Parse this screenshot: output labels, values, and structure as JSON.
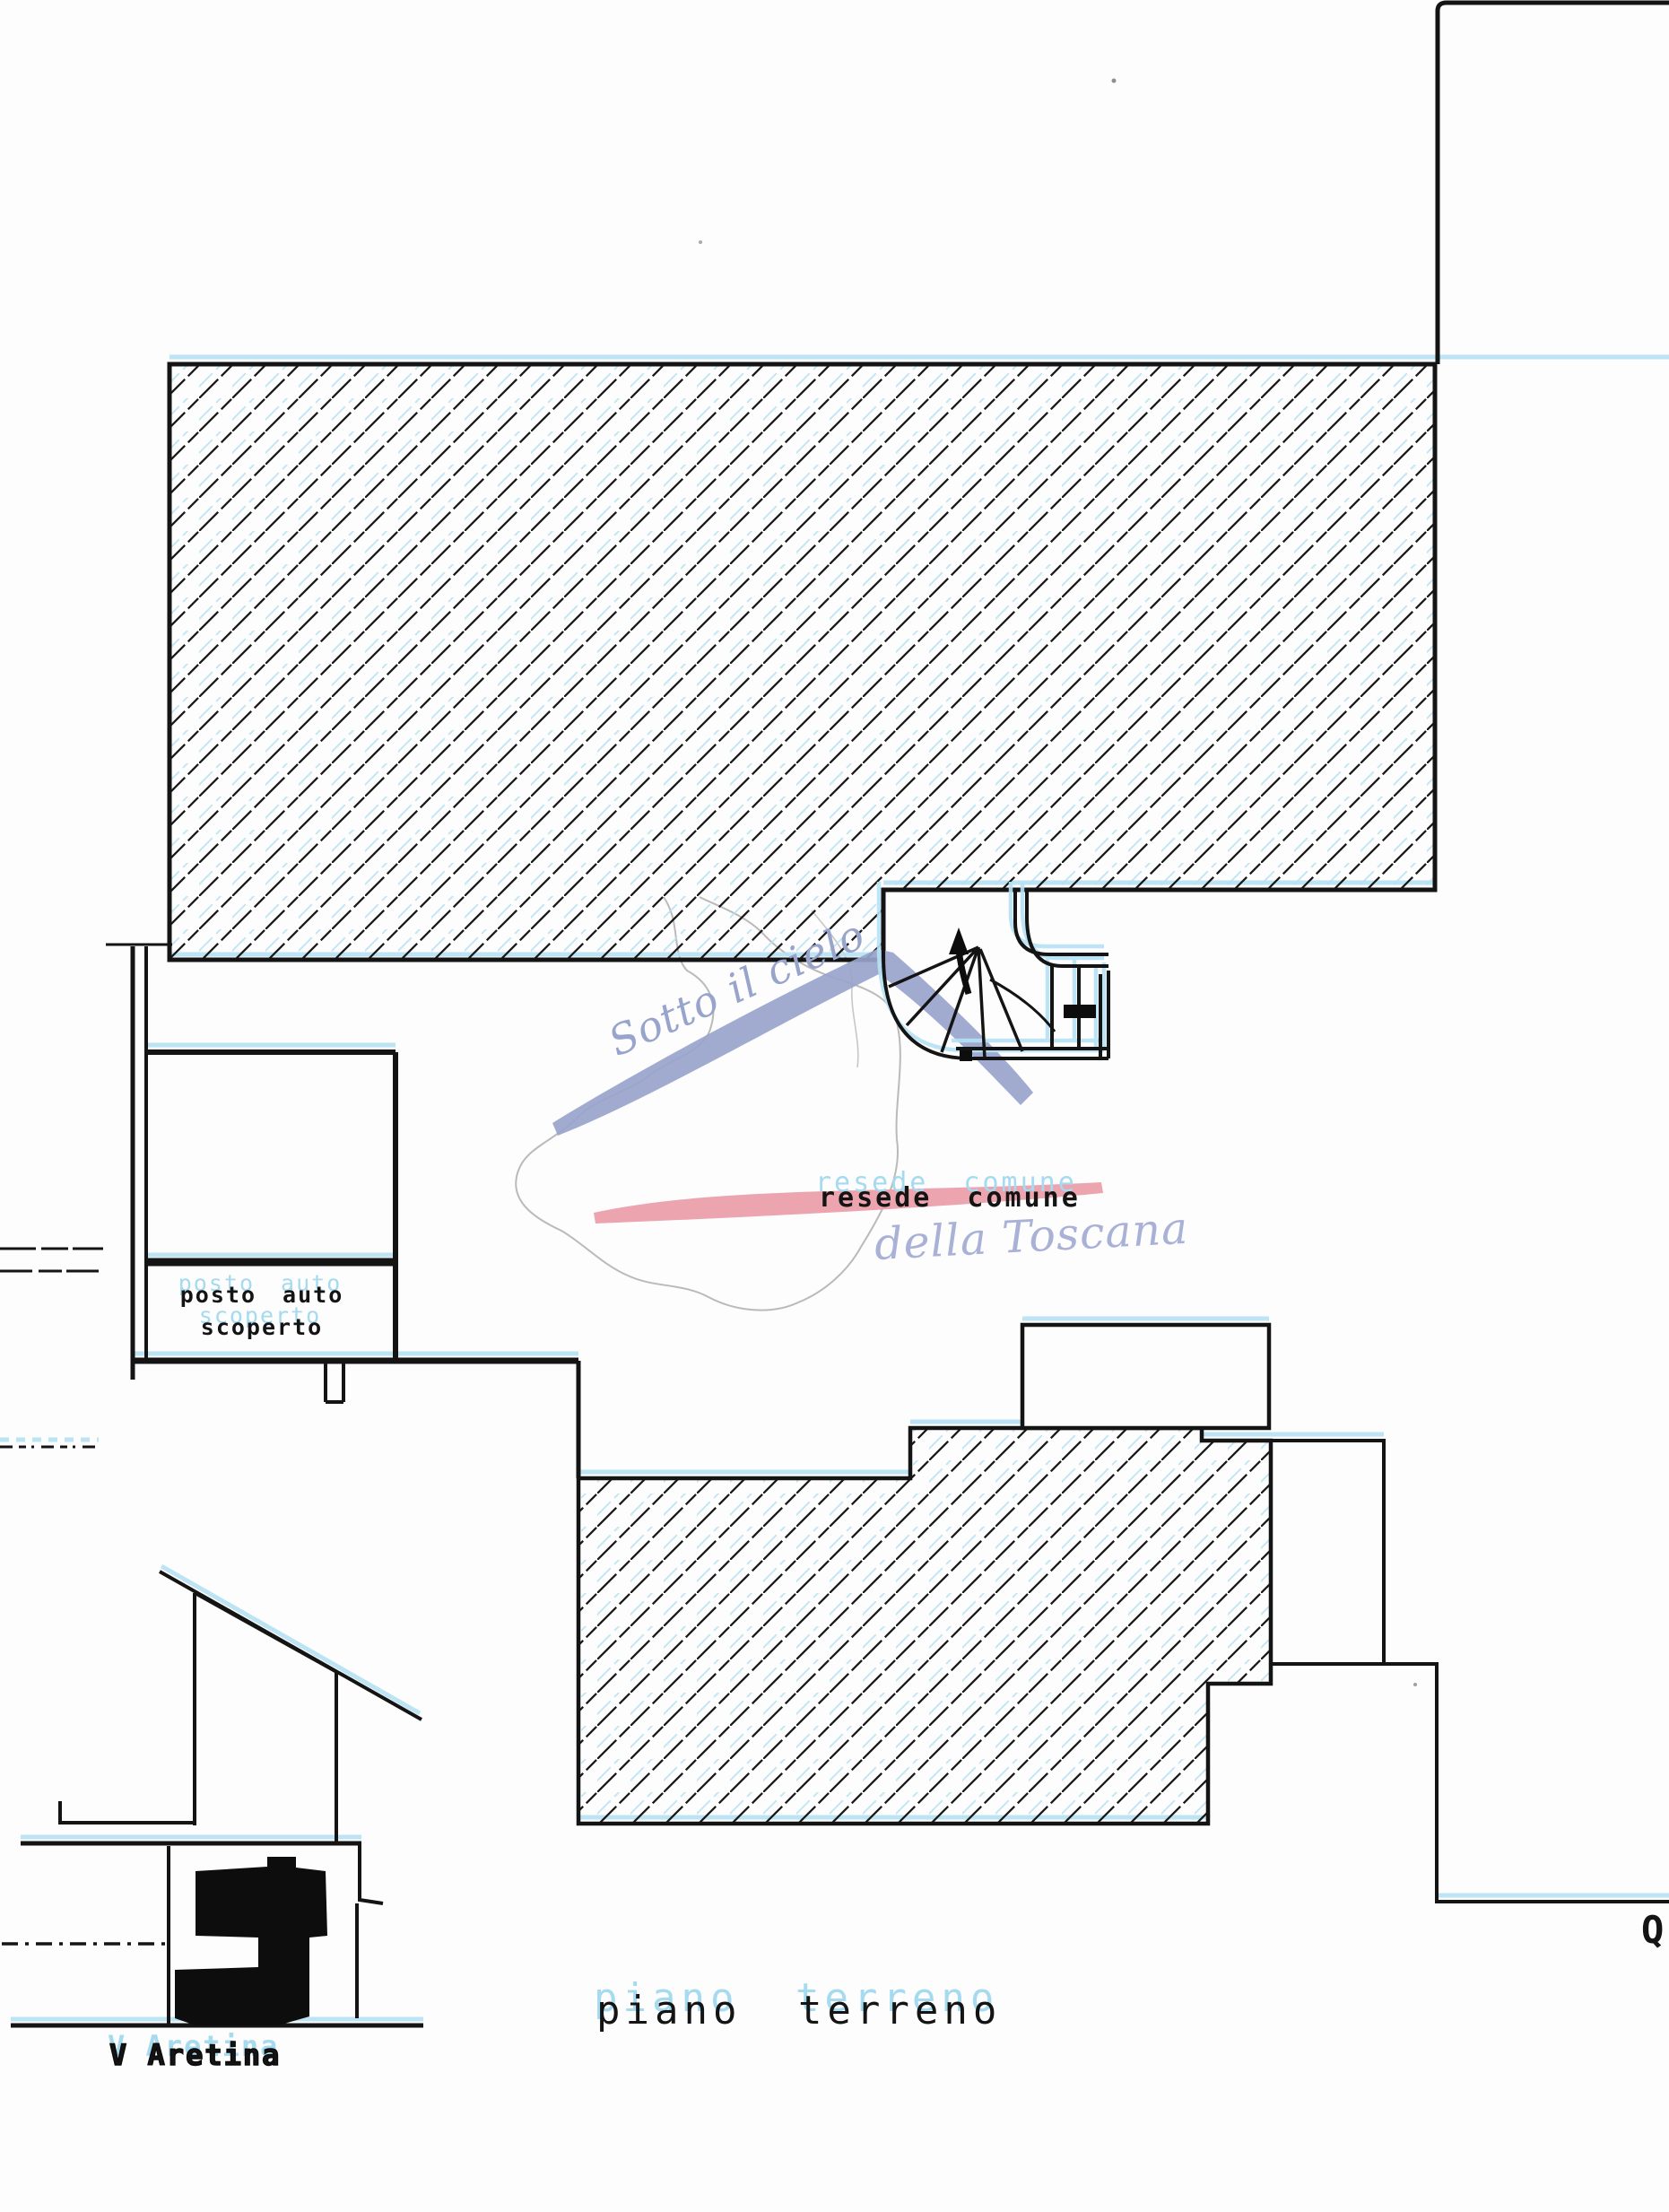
{
  "document": {
    "title": "piano terreno",
    "kind": "scanned cadastral floor plan"
  },
  "labels": {
    "resede_comune": "resede comune",
    "posto_auto_line1": "posto auto",
    "posto_auto_line2": "scoperto",
    "floor_title": "piano terreno",
    "street": "V Aretina",
    "letter_q": "Q"
  },
  "watermark": {
    "line1": "Sotto il cielo",
    "line2": "della Toscana"
  },
  "colors": {
    "ink": "#141414",
    "ghost_cyan": "#a9ddf2",
    "watermark_blue": "#98a4cb",
    "watermark_blue_light": "#a9b1d6",
    "watermark_pink": "#eb9fab",
    "map_outline": "#b3b3b3",
    "paper": "#fdfdfd",
    "solid_black": "#0d0d0d"
  }
}
